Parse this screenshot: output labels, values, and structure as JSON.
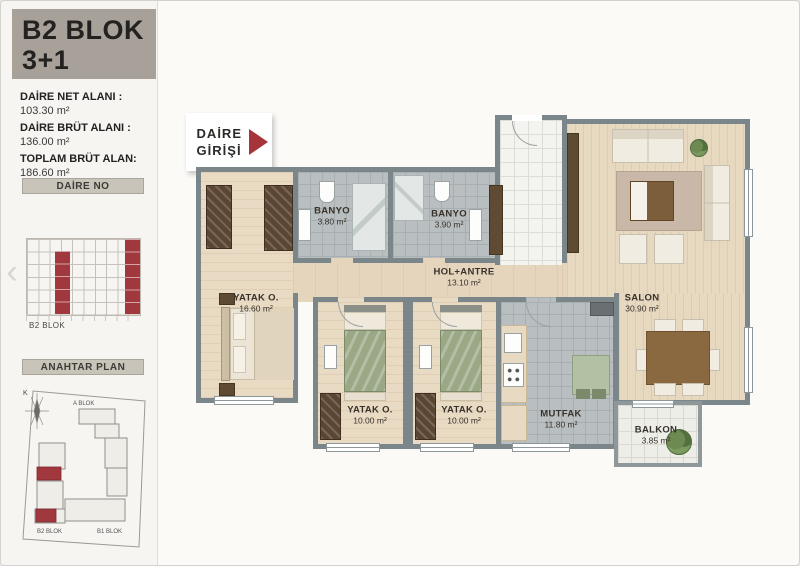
{
  "colors": {
    "accent_red": "#a6343b",
    "wall_gray": "#7b868a",
    "sidebar_header_bg": "#a7a19a",
    "bar_bg": "#c9c4ba"
  },
  "sidebar": {
    "block_title": "B2 BLOK",
    "unit_type": "3+1",
    "stats": [
      {
        "label": "DAİRE NET ALANI :",
        "value": "103.30 m²"
      },
      {
        "label": "DAİRE BRÜT ALANI :",
        "value": "136.00 m²"
      },
      {
        "label": "TOPLAM BRÜT ALAN:",
        "value": "186.60 m²"
      }
    ],
    "daire_no_header": "DAİRE NO",
    "elevation_caption": "B2 BLOK",
    "anahtar_header": "ANAHTAR PLAN",
    "site": {
      "a_blok": "A BLOK",
      "b1_blok": "B1 BLOK",
      "b2_blok": "B2 BLOK",
      "north": "K"
    },
    "icons": {
      "prev": "‹"
    }
  },
  "plan": {
    "entrance": {
      "line1": "DAİRE",
      "line2": "GİRİŞİ"
    },
    "rooms": [
      {
        "name": "YATAK O.",
        "area": "16.60 m²"
      },
      {
        "name": "BANYO",
        "area": "3.80 m²"
      },
      {
        "name": "BANYO",
        "area": "3.90 m²"
      },
      {
        "name": "HOL+ANTRE",
        "area": "13.10 m²"
      },
      {
        "name": "SALON",
        "area": "30.90 m²"
      },
      {
        "name": "YATAK O.",
        "area": "10.00 m²"
      },
      {
        "name": "YATAK O.",
        "area": "10.00 m²"
      },
      {
        "name": "MUTFAK",
        "area": "11.80 m²"
      },
      {
        "name": "BALKON",
        "area": "3.85 m²"
      }
    ]
  }
}
